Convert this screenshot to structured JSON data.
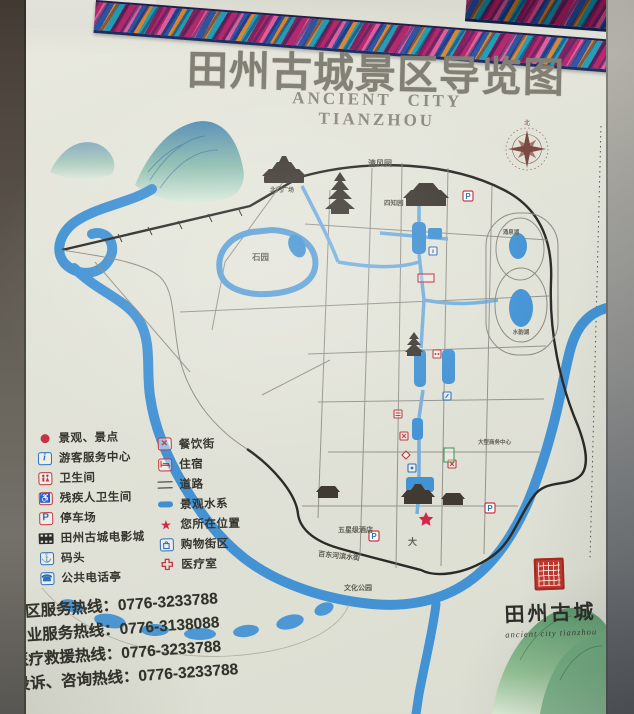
{
  "sign": {
    "title": "田州古城景区导览图",
    "subtitle": "ANCIENT CITY TIANZHOU",
    "legend": {
      "left": [
        {
          "icon": "scenic-spot-icon",
          "label": "景观、景点"
        },
        {
          "icon": "visitor-center-icon",
          "label": "游客服务中心"
        },
        {
          "icon": "toilet-icon",
          "label": "卫生间"
        },
        {
          "icon": "accessible-toilet-icon",
          "label": "残疾人卫生间"
        },
        {
          "icon": "parking-icon",
          "label": "停车场"
        },
        {
          "icon": "cinema-icon",
          "label": "田州古城电影城"
        },
        {
          "icon": "dock-icon",
          "label": "码头"
        },
        {
          "icon": "phone-booth-icon",
          "label": "公共电话亭"
        }
      ],
      "right": [
        {
          "icon": "dining-street-icon",
          "label": "餐饮街"
        },
        {
          "icon": "lodging-icon",
          "label": "住宿"
        },
        {
          "icon": "road-icon",
          "label": "道路"
        },
        {
          "icon": "water-icon",
          "label": "景观水系"
        },
        {
          "icon": "your-location-icon",
          "label": "您所在位置"
        },
        {
          "icon": "shopping-district-icon",
          "label": "购物街区"
        },
        {
          "icon": "medical-room-icon",
          "label": "医疗室"
        }
      ]
    },
    "hotlines": [
      "景区服务热线：0776-3233788",
      "物业服务热线：0776-3138088",
      "医疗救援热线：0776-3233788",
      "投诉、咨询热线：0776-3233788"
    ],
    "map": {
      "labels": {
        "qingfengyuan": "清风园",
        "beimen_square": "北门广场",
        "sizhiyuan": "四知园",
        "shiyuan": "石园",
        "yongquan_lake": "涌泉湖",
        "shuiyun_lake": "水韵湖",
        "hotel": "五星级酒店",
        "riverside_street": "百东河滨水街",
        "culture_park": "文化公园",
        "business_center": "大型商务中心",
        "da_street": "大"
      },
      "markers": {
        "parking": "P"
      }
    },
    "seal": {
      "name": "田州古城",
      "script": "ancient city tianzhou"
    },
    "compass_north": "北"
  }
}
